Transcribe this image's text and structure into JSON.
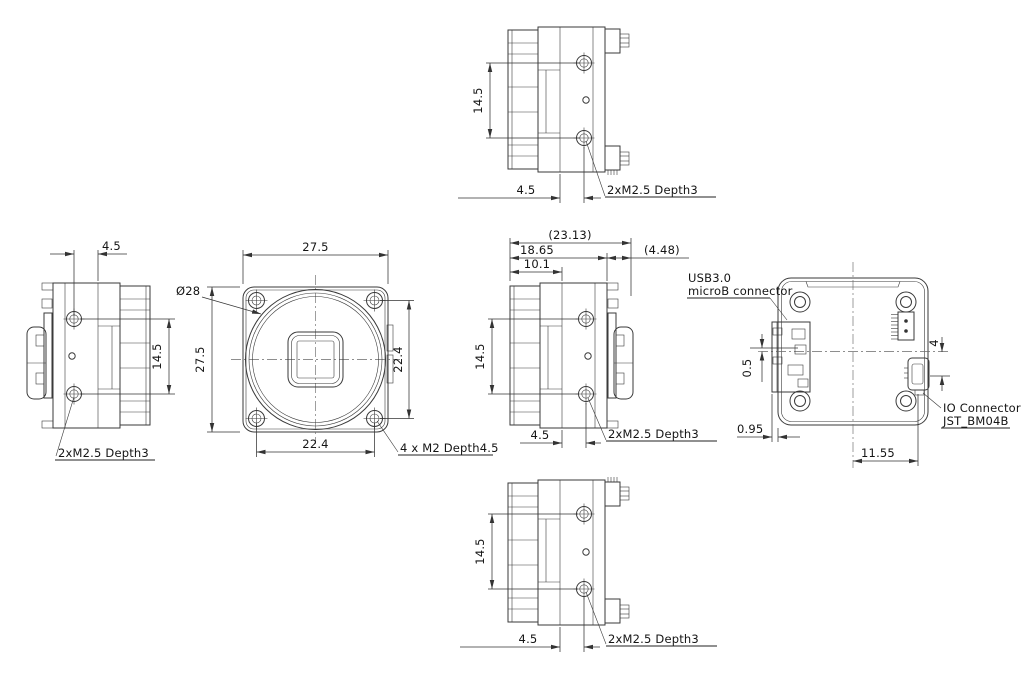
{
  "drawing": {
    "type": "mechanical-outline-drawing",
    "line_color": "#3a3a3a",
    "background": "#ffffff",
    "views": {
      "top": {
        "dim_hole_span": "14.5",
        "dim_hole_offset": "4.5",
        "label_screws": "2xM2.5 Depth3"
      },
      "left": {
        "dim_hole_offset": "4.5",
        "dim_hole_span": "14.5",
        "label_screws": "2xM2.5 Depth3"
      },
      "front": {
        "dim_width": "27.5",
        "dim_height": "27.5",
        "dim_lens_dia": "Ø28",
        "dim_mount_span_v": "22.4",
        "dim_mount_span_h": "22.4",
        "label_screws": "4 x M2 Depth4.5"
      },
      "side": {
        "dim_total_depth": "(23.13)",
        "dim_body_depth": "18.65",
        "dim_connector_depth": "(4.48)",
        "dim_front_depth": "10.1",
        "dim_hole_span": "14.5",
        "dim_hole_offset": "4.5",
        "label_screws": "2xM2.5 Depth3"
      },
      "back": {
        "label_usb_line1": "USB3.0",
        "label_usb_line2": "microB connector",
        "dim_usb_offset": "0.5",
        "dim_usb_protrusion": "0.95",
        "dim_io_span": "11.55",
        "dim_io_offset": "4",
        "label_io_line1": "IO Connector",
        "label_io_line2": "JST_BM04B"
      },
      "bottom": {
        "dim_hole_span": "14.5",
        "dim_hole_offset": "4.5",
        "label_screws": "2xM2.5 Depth3"
      }
    }
  }
}
